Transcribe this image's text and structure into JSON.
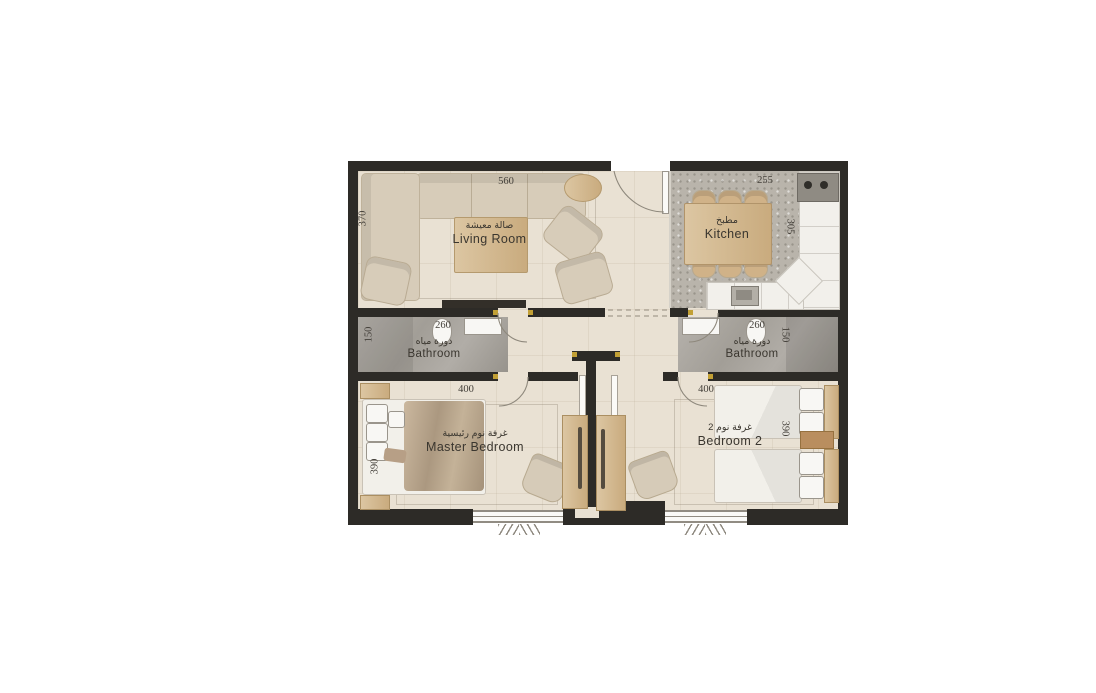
{
  "title": "apartment-floor-plan",
  "colors": {
    "wall": "#2d2b27",
    "floor": "#e9e1d3",
    "kitchen_floor": "#b9b4ab",
    "bathroom_floor": "#a8a39c",
    "wood": "#d0b288",
    "furniture": "#d7ccb9",
    "accent_yellow": "#c2a035",
    "background": "#ffffff"
  },
  "rooms": [
    {
      "id": "living-room",
      "name_ar": "صالة معيشة",
      "name_en": "Living Room",
      "dim_width": "560",
      "dim_depth": "370"
    },
    {
      "id": "kitchen",
      "name_ar": "مطبخ",
      "name_en": "Kitchen",
      "dim_width": "255",
      "dim_depth": "305"
    },
    {
      "id": "bathroom-1",
      "name_ar": "دورة مياه",
      "name_en": "Bathroom",
      "dim_width": "260",
      "dim_depth": "150"
    },
    {
      "id": "bathroom-2",
      "name_ar": "دورة مياه",
      "name_en": "Bathroom",
      "dim_width": "260",
      "dim_depth": "150"
    },
    {
      "id": "master-bedroom",
      "name_ar": "غرفة نوم رئيسية",
      "name_en": "Master Bedroom",
      "dim_width": "400",
      "dim_depth": "390"
    },
    {
      "id": "bedroom-2",
      "name_ar": "غرفة نوم 2",
      "name_en": "Bedroom 2",
      "dim_width": "400",
      "dim_depth": "390"
    }
  ]
}
